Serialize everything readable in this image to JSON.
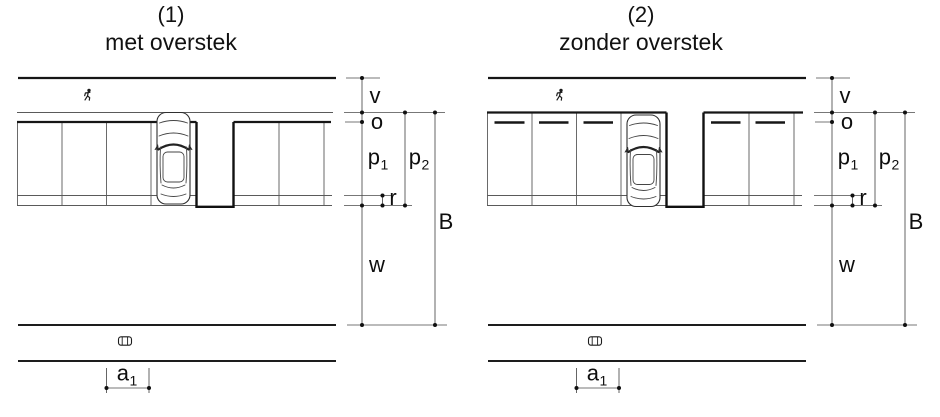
{
  "figure": {
    "panels": [
      {
        "number": "(1)",
        "title": "met overstek"
      },
      {
        "number": "(2)",
        "title": "zonder overstek"
      }
    ],
    "dimension_labels": {
      "v": "v",
      "o": "o",
      "p1": {
        "base": "p",
        "sub": "1"
      },
      "p2": {
        "base": "p",
        "sub": "2"
      },
      "r": "r",
      "B": "B",
      "w": "w",
      "a1": {
        "base": "a",
        "sub": "1"
      }
    },
    "icons": {
      "sidewalk_strip": "pedestrian-icon",
      "roadway_strip": "car-icon"
    },
    "colors": {
      "line": "#161616",
      "thin_line": "#5a5a5a",
      "background": "#ffffff"
    }
  }
}
